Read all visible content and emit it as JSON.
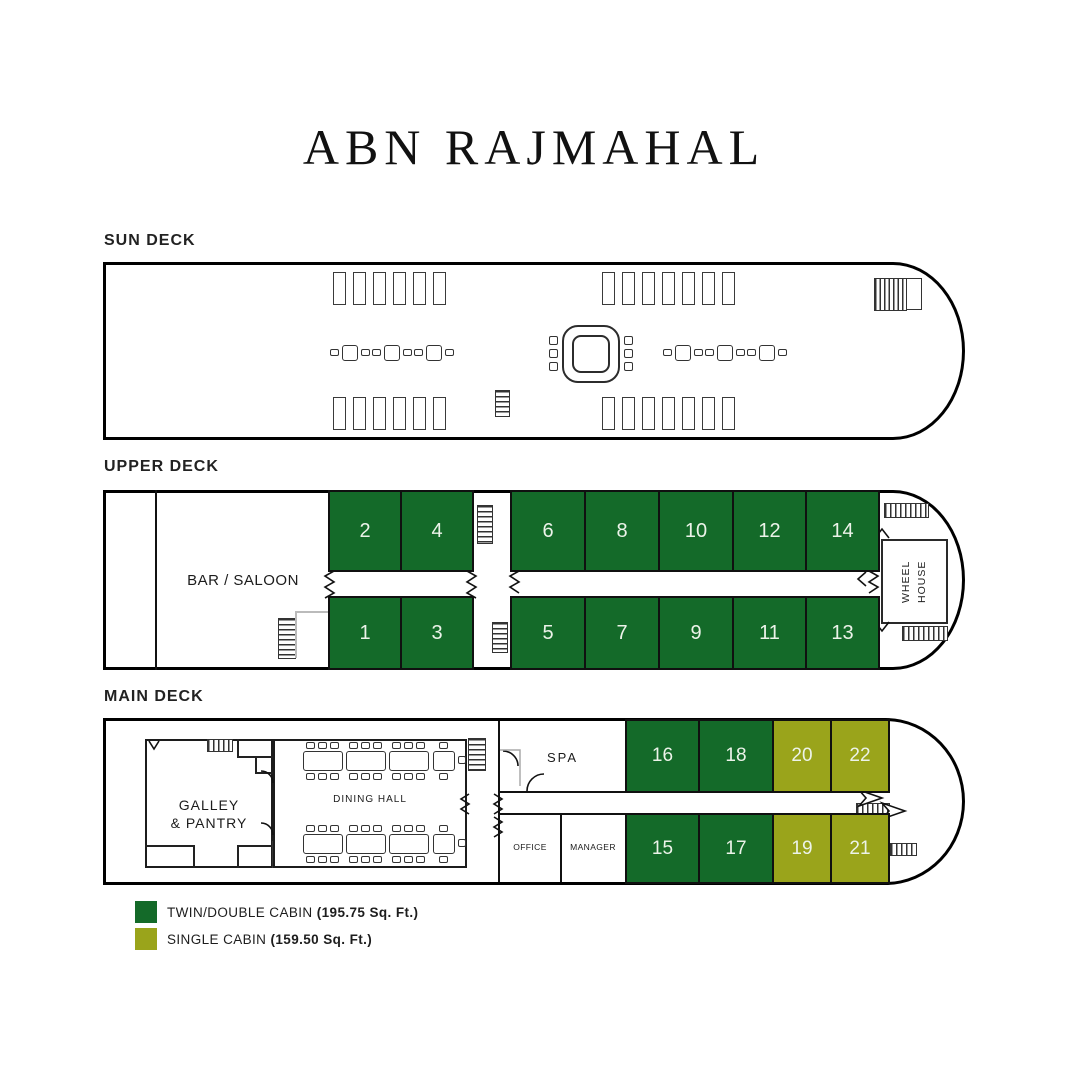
{
  "title": "ABN RAJMAHAL",
  "colors": {
    "twin_cabin": "#146a29",
    "single_cabin": "#9aa41b",
    "outline": "#000000"
  },
  "sun_deck": {
    "label": "SUN DECK"
  },
  "upper_deck": {
    "label": "UPPER DECK",
    "bar_saloon": "BAR / SALOON",
    "wheel_house": "WHEEL HOUSE",
    "cabins_forward_row": [
      "2",
      "4",
      "6",
      "8",
      "10",
      "12",
      "14"
    ],
    "cabins_aft_row": [
      "1",
      "3",
      "5",
      "7",
      "9",
      "11",
      "13"
    ]
  },
  "main_deck": {
    "label": "MAIN DECK",
    "galley_line1": "GALLEY",
    "galley_line2": "& PANTRY",
    "dining_hall": "DINING HALL",
    "spa": "SPA",
    "office": "OFFICE",
    "manager": "MANAGER",
    "cabins_top_row": [
      {
        "num": "16",
        "type": "twin"
      },
      {
        "num": "18",
        "type": "twin"
      },
      {
        "num": "20",
        "type": "single"
      },
      {
        "num": "22",
        "type": "single"
      }
    ],
    "cabins_bottom_row": [
      {
        "num": "15",
        "type": "twin"
      },
      {
        "num": "17",
        "type": "twin"
      },
      {
        "num": "19",
        "type": "single"
      },
      {
        "num": "21",
        "type": "single"
      }
    ]
  },
  "legend": [
    {
      "type": "twin",
      "label": "TWIN/DOUBLE CABIN",
      "detail": "(195.75 Sq. Ft.)"
    },
    {
      "type": "single",
      "label": "SINGLE CABIN",
      "detail": "(159.50 Sq. Ft.)"
    }
  ]
}
